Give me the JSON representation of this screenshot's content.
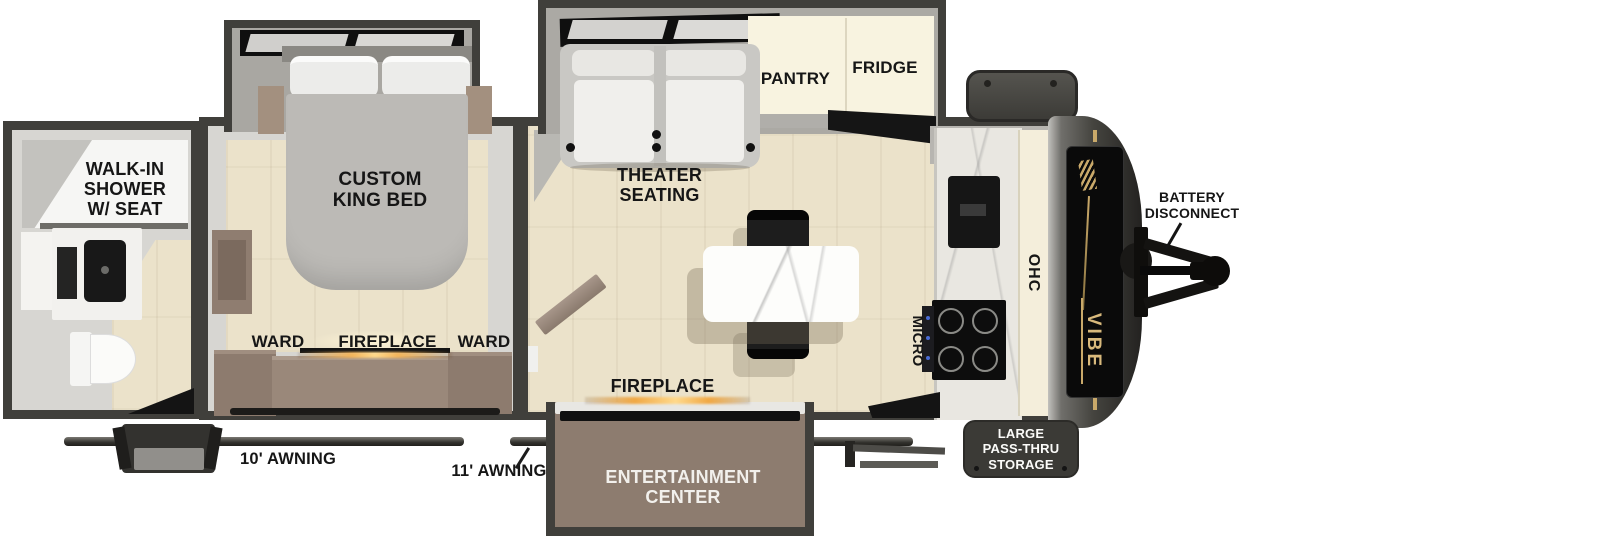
{
  "title": "Travel trailer floor plan",
  "colors": {
    "wall": "#403f3b",
    "floor": "#ebe2ca",
    "cabinet_brown": "#8d7b6e",
    "cream": "#f8f3e0",
    "brand_gold": "#c9a96a",
    "fireplace_glow": "#ffd98c"
  },
  "rear_bath": {
    "label": "WALK-IN\nSHOWER\nW/ SEAT"
  },
  "bedroom": {
    "bed": "CUSTOM\nKING BED",
    "ward_left": "WARD",
    "fireplace": "FIREPLACE",
    "ward_right": "WARD"
  },
  "living": {
    "theater": "THEATER\nSEATING",
    "pantry": "PANTRY",
    "fridge": "FRIDGE",
    "fireplace": "FIREPLACE",
    "micro": "MICRO",
    "ohc": "OHC",
    "entertainment": "ENTERTAINMENT\nCENTER"
  },
  "front": {
    "brand": "VIBE",
    "battery": "BATTERY\nDISCONNECT",
    "storage": "LARGE\nPASS-THRU\nSTORAGE"
  },
  "awnings": {
    "door_side_rear": "10' AWNING",
    "door_side_front": "11' AWNING"
  }
}
